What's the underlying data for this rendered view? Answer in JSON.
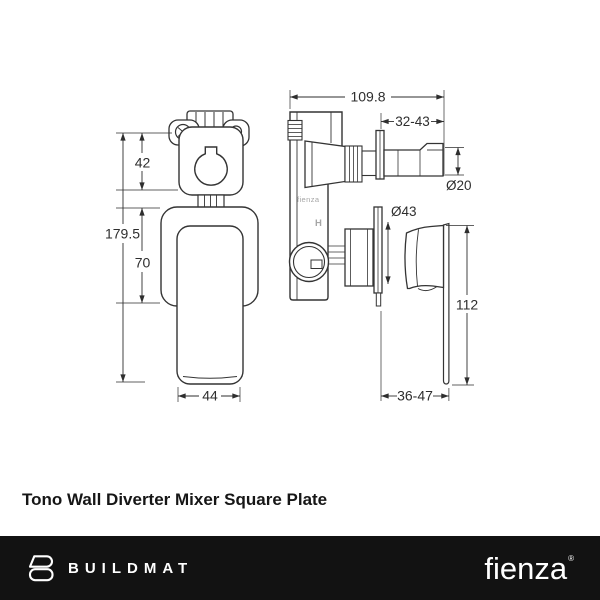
{
  "title": "Tono Wall Diverter Mixer Square Plate",
  "drawing": {
    "front_view": {
      "dim_top_section_height": "42",
      "dim_overall_height": "179.5",
      "dim_plate_height": "70",
      "dim_handle_width": "44"
    },
    "side_view": {
      "dim_overall_depth": "109.8",
      "dim_spout_adjust": "32-43",
      "dim_spout_diameter": "Ø20",
      "dim_cartridge_diameter": "Ø43",
      "dim_handle_height": "112",
      "dim_handle_depth": "36-47",
      "body_brand_text": "fienza",
      "body_h_mark": "H"
    }
  },
  "footer": {
    "buildmat_text": "BUILDMAT",
    "fienza_text": "fienza",
    "fienza_reg_mark": "®"
  },
  "colors": {
    "line": "#343434",
    "dim_text": "#2e2e2e",
    "body_mark_gray": "#a6a6a6",
    "footer_bg": "#121212",
    "footer_text": "#ffffff",
    "background": "#ffffff"
  }
}
